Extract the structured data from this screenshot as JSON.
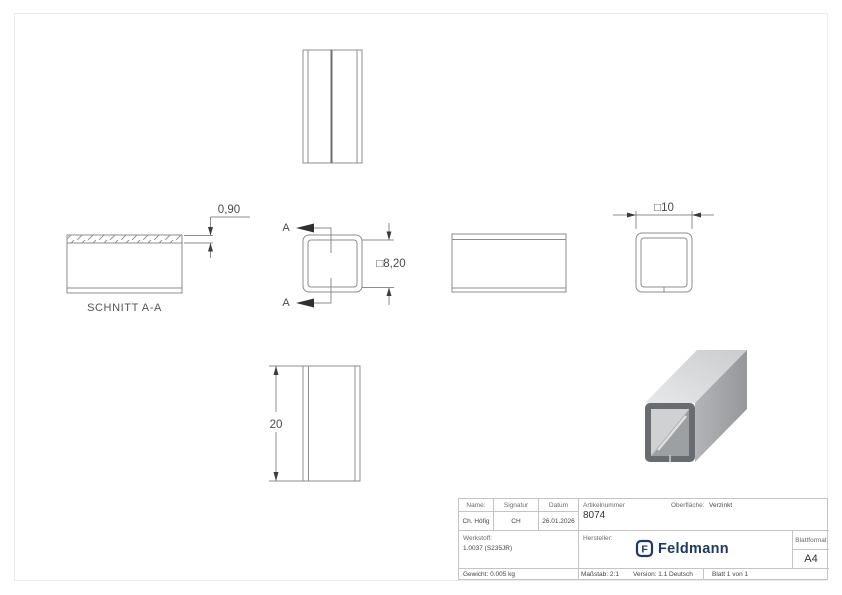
{
  "drawing": {
    "section_title": "SCHNITT A-A",
    "cut_label": "A",
    "dim_wall": "0,90",
    "dim_inner": "□8,20",
    "dim_outer": "□10",
    "dim_length": "20"
  },
  "title_block": {
    "headers": {
      "name": "Name:",
      "signature": "Signatur",
      "date": "Datum"
    },
    "values": {
      "name": "Ch. Höfig",
      "signature": "CH",
      "date": "26.01.2026"
    },
    "article": {
      "label": "Artikelnummer",
      "number": "8074"
    },
    "surface": {
      "label": "Oberfläche:",
      "value": "Verzinkt"
    },
    "material": {
      "label": "Werkstoff:",
      "value": "1.0037 (S235JR)"
    },
    "manufacturer_label": "Hersteller:",
    "brand": {
      "initial": "F",
      "name": "Feldmann"
    },
    "sheet_format": {
      "label": "Blattformat",
      "value": "A4"
    },
    "weight": "Gewicht: 0.005 kg",
    "scale": "Maßstab: 2:1",
    "version": "Version: 1.1",
    "language": "Deutsch",
    "sheet": "Blatt 1 von 1"
  },
  "colors": {
    "brand_navy": "#1d3a66",
    "line_gray": "#8c8c8c",
    "frame_gray": "#ebebeb"
  }
}
